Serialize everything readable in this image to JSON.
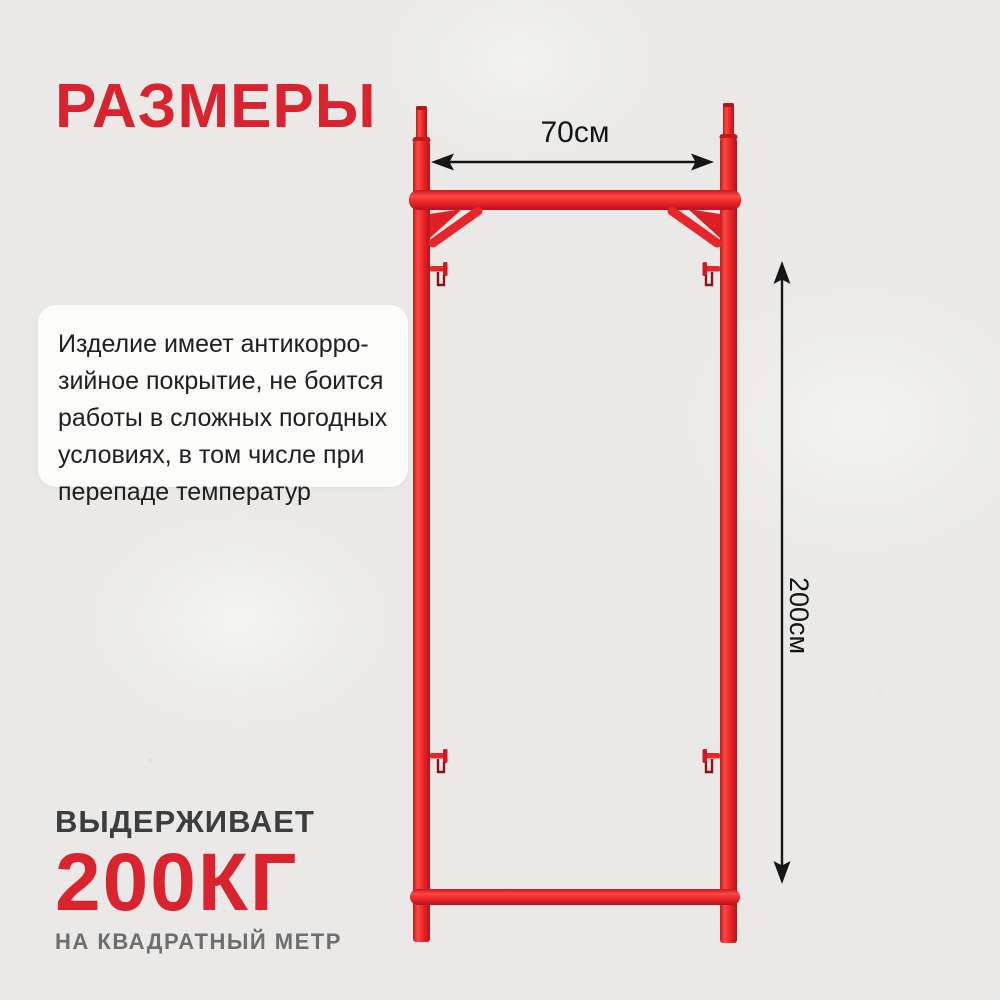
{
  "title": "РАЗМЕРЫ",
  "dimension_labels": {
    "width": "70см",
    "height": "200см"
  },
  "description_lines": [
    "Изделие имеет антикорро-",
    "зийное покрытие, не боится",
    "работы в сложных погодных",
    "условиях, в том числе при",
    "перепаде температур"
  ],
  "capacity": {
    "heading": "ВЫДЕРЖИВАЕТ",
    "value": "200КГ",
    "caption": "НА КВАДРАТНЫЙ МЕТР"
  },
  "colors": {
    "accent_red": "#d9232e",
    "frame_red": "#ee2428",
    "arrow_black": "#161616",
    "background": "#eae9e7",
    "card_white": "#fcfcfb",
    "text_dark": "#202020",
    "heading_gray": "#3d3d3d",
    "caption_gray": "#6e6e6e"
  },
  "icons": {
    "width_arrow": "double-headed-horizontal-dimension-arrow",
    "height_arrow": "double-headed-vertical-dimension-arrow"
  }
}
